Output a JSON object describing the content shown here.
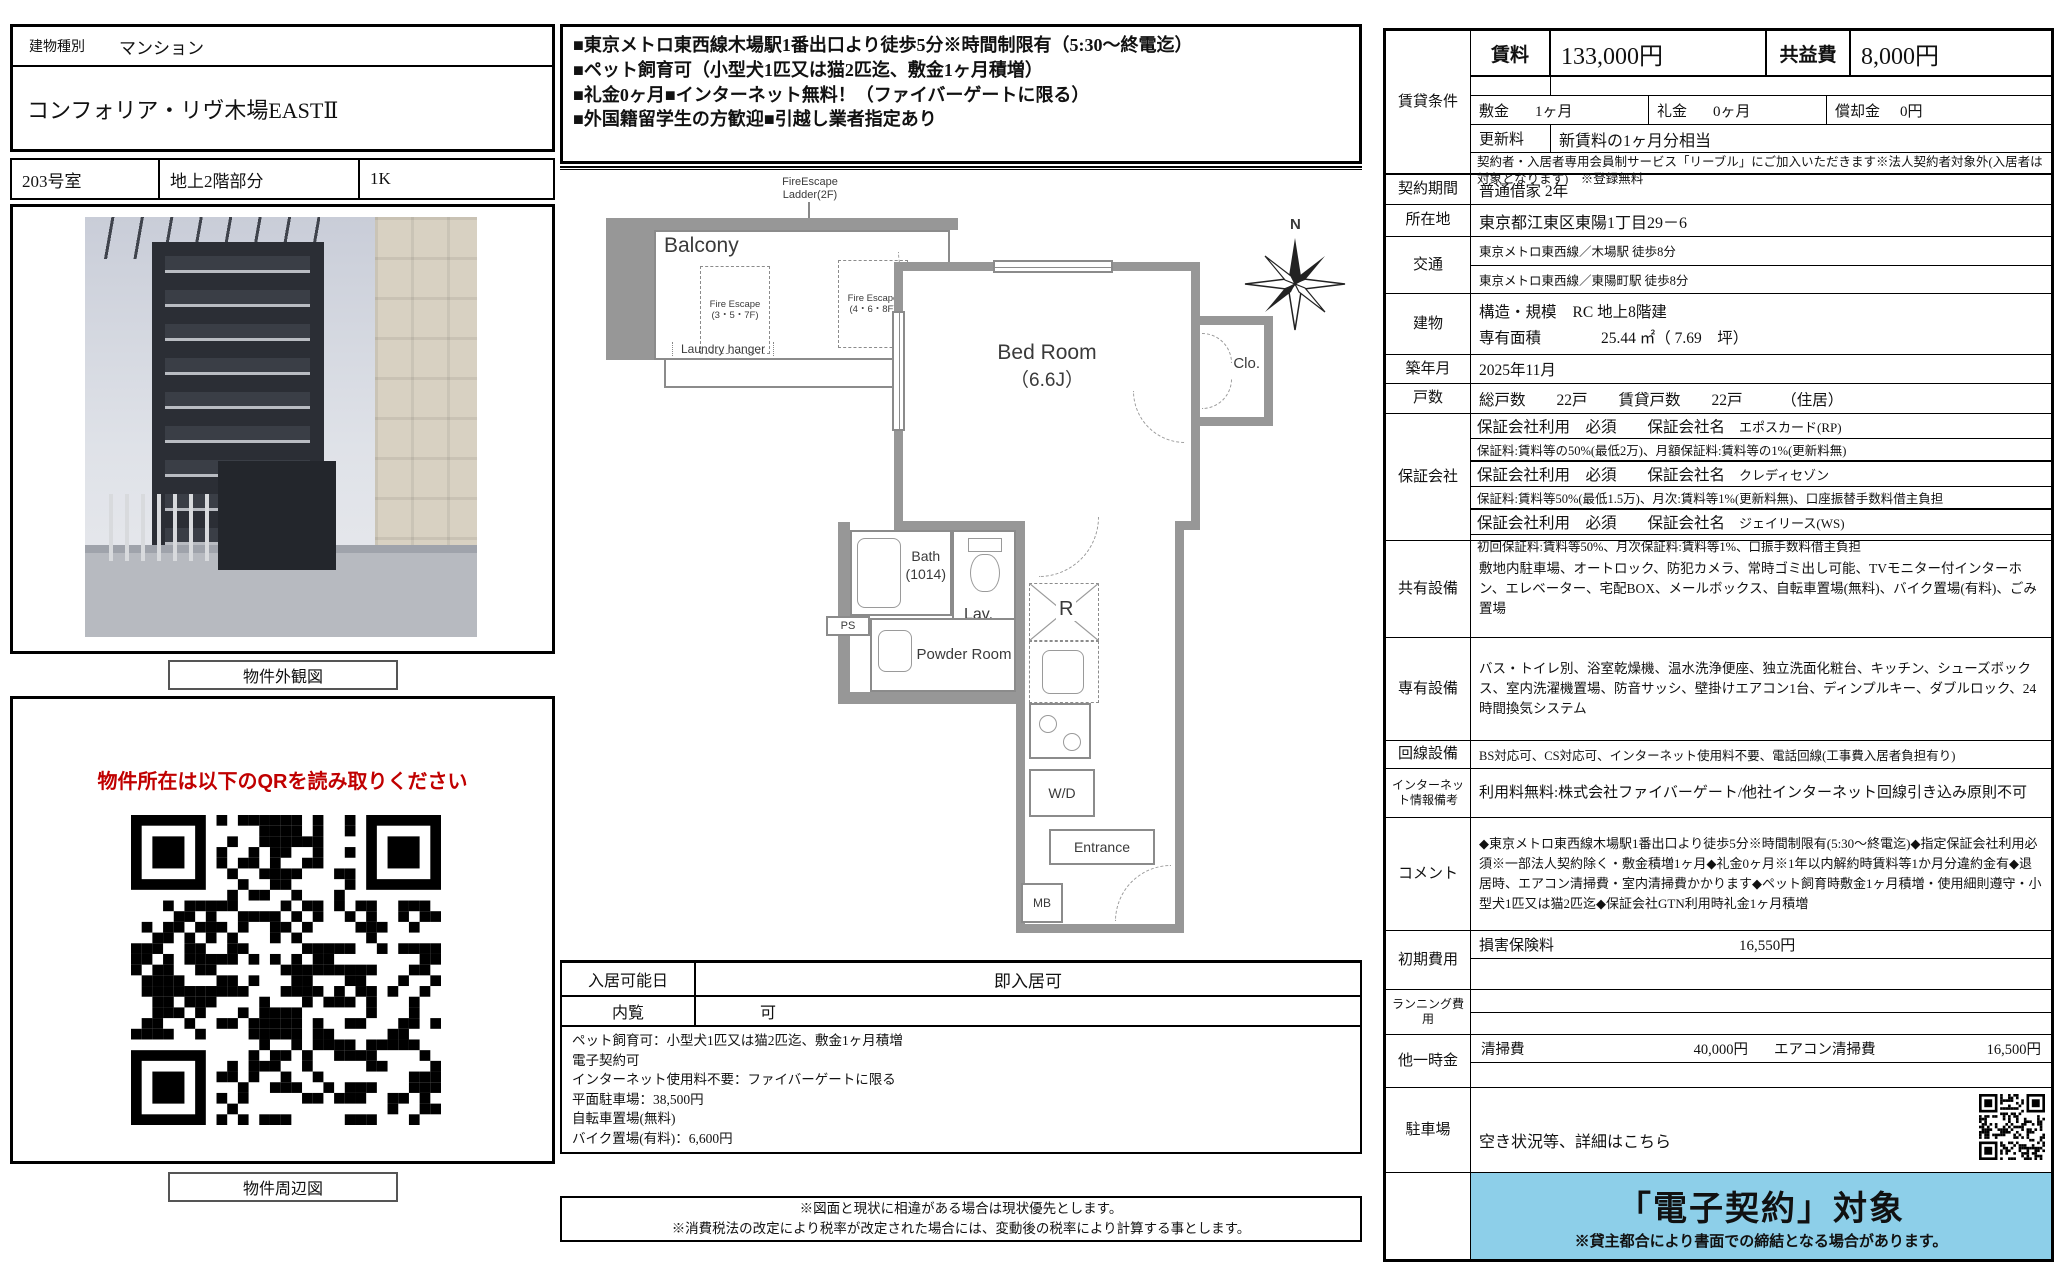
{
  "colors": {
    "accent_red": "#c00000",
    "banner_blue": "#8dcfe9",
    "wall_gray": "#979797"
  },
  "left": {
    "building_type_label": "建物種別",
    "building_type": "マンション",
    "property_name": "コンフォリア・リヴ木場EASTⅡ",
    "room_no": "203号室",
    "room_floor": "地上2階部分",
    "room_layout": "1K",
    "photo_caption": "物件外観図",
    "qr_notice": "物件所在は以下のQRを読み取りください",
    "map_caption": "物件周辺図"
  },
  "center": {
    "highlights": [
      "■東京メトロ東西線木場駅1番出口より徒歩5分※時間制限有（5:30～終電迄）",
      "■ペット飼育可（小型犬1匹又は猫2匹迄、敷金1ヶ月積増）",
      "■礼金0ヶ月■インターネット無料！（ファイバーゲートに限る）",
      "■外国籍留学生の方歓迎■引越し業者指定あり"
    ],
    "floorplan": {
      "ladder_line1": "FireEscape",
      "ladder_line2": "Ladder(2F)",
      "balcony": "Balcony",
      "fire_escape_1": "Fire Escape (3・5・7F)",
      "fire_escape_2": "Fire Escape (4・6・8F)",
      "laundry": "Laundry hanger",
      "bedroom": "Bed Room",
      "bedroom_size": "（6.6J）",
      "closet": "Clo.",
      "bath": "Bath",
      "bath_size": "(1014)",
      "lav": "Lav.",
      "ps": "PS",
      "powder": "Powder Room",
      "fridge": "R",
      "wd": "W/D",
      "entrance": "Entrance",
      "mb": "MB",
      "compass_n": "N"
    },
    "move_in_label": "入居可能日",
    "move_in_value": "即入居可",
    "viewing_label": "内覧",
    "viewing_value": "可",
    "notes": [
      "ペット飼育可：小型犬1匹又は猫2匹迄、敷金1ヶ月積増",
      "電子契約可",
      "インターネット使用料不要：ファイバーゲートに限る",
      "平面駐車場：38,500円",
      "自転車置場(無料)",
      "バイク置場(有料)：6,600円"
    ],
    "footnotes": [
      "※図面と現状に相違がある場合は現状優先とします。",
      "※消費税法の改定により税率が改定された場合には、変動後の税率により計算する事とします。"
    ]
  },
  "right": {
    "lease_label": "賃貸条件",
    "rent_label": "賃料",
    "rent_value": "133,000円",
    "common_fee_label": "共益費",
    "common_fee_value": "8,000円",
    "deposit_label": "敷金",
    "deposit_value": "1ヶ月",
    "key_money_label": "礼金",
    "key_money_value": "0ヶ月",
    "amortization_label": "償却金",
    "amortization_value": "0円",
    "renewal_label": "更新料",
    "renewal_value": "新賃料の1ヶ月分相当",
    "membership_note": "契約者・入居者専用会員制サービス「リーブル」にご加入いただきます※法人契約者対象外(入居者は対象となります)　※登録無料",
    "contract_label": "契約期間",
    "contract_value": "普通借家 2年",
    "address_label": "所在地",
    "address_value": "東京都江東区東陽1丁目29－6",
    "access_label": "交通",
    "access_lines": [
      "東京メトロ東西線／木場駅 徒歩8分",
      "東京メトロ東西線／東陽町駅 徒歩8分"
    ],
    "building_label": "建物",
    "structure_label": "構造・規模",
    "structure_value": "RC 地上8階建",
    "area_label": "専有面積",
    "area_value": "25.44 ㎡（ 7.69　坪）",
    "built_label": "築年月",
    "built_value": "2025年11月",
    "units_label": "戸数",
    "units_value": "総戸数　　22戸　　賃貸戸数　　22戸　　　（住居）",
    "guarantor_label": "保証会社",
    "guarantor_header": "保証会社利用　必須　　保証会社名",
    "guarantors": [
      {
        "name": "エポスカード(RP)",
        "detail": "保証料:賃料等の50%(最低2万)、月額保証料:賃料等の1%(更新料無)"
      },
      {
        "name": "クレディセゾン",
        "detail": "保証料:賃料等50%(最低1.5万)、月次:賃料等1%(更新料無)、口座振替手数料借主負担"
      },
      {
        "name": "ジェイリース(WS)",
        "detail": "初回保証料:賃料等50%、月次保証料:賃料等1%、口振手数料借主負担"
      }
    ],
    "shared_label": "共有設備",
    "shared_value": "敷地内駐車場、オートロック、防犯カメラ、常時ゴミ出し可能、TVモニター付インターホン、エレベーター、宅配BOX、メールボックス、自転車置場(無料)、バイク置場(有料)、ごみ置場",
    "private_label": "専有設備",
    "private_value": "バス・トイレ別、浴室乾燥機、温水洗浄便座、独立洗面化粧台、キッチン、シューズボックス、室内洗濯機置場、防音サッシ、壁掛けエアコン1台、ディンプルキー、ダブルロック、24時間換気システム",
    "line_label": "回線設備",
    "line_value": "BS対応可、CS対応可、インターネット使用料不要、電話回線(工事費入居者負担有り)",
    "internet_label": "インターネット情報備考",
    "internet_value": "利用料無料:株式会社ファイバーゲート/他社インターネット回線引き込み原則不可",
    "comment_label": "コメント",
    "comment_value": "◆東京メトロ東西線木場駅1番出口より徒歩5分※時間制限有(5:30～終電迄)◆指定保証会社利用必須※一部法人契約除く・敷金積増1ヶ月◆礼金0ヶ月※1年以内解約時賃料等1か月分違約金有◆退居時、エアコン清掃費・室内清掃費かかります◆ペット飼育時敷金1ヶ月積増・使用細則遵守・小型犬1匹又は猫2匹迄◆保証会社GTN利用時礼金1ヶ月積増",
    "initial_label": "初期費用",
    "insurance_label": "損害保険料",
    "insurance_value": "16,550円",
    "running_label": "ランニング費用",
    "other_label": "他一時金",
    "cleaning_label": "清掃費",
    "cleaning_value": "40,000円",
    "ac_cleaning_label": "エアコン清掃費",
    "ac_cleaning_value": "16,500円",
    "parking_label": "駐車場",
    "parking_value": "空き状況等、詳細はこちら",
    "banner_title": "「電子契約」対象",
    "banner_note": "※貸主都合により書面での締結となる場合があります。"
  }
}
